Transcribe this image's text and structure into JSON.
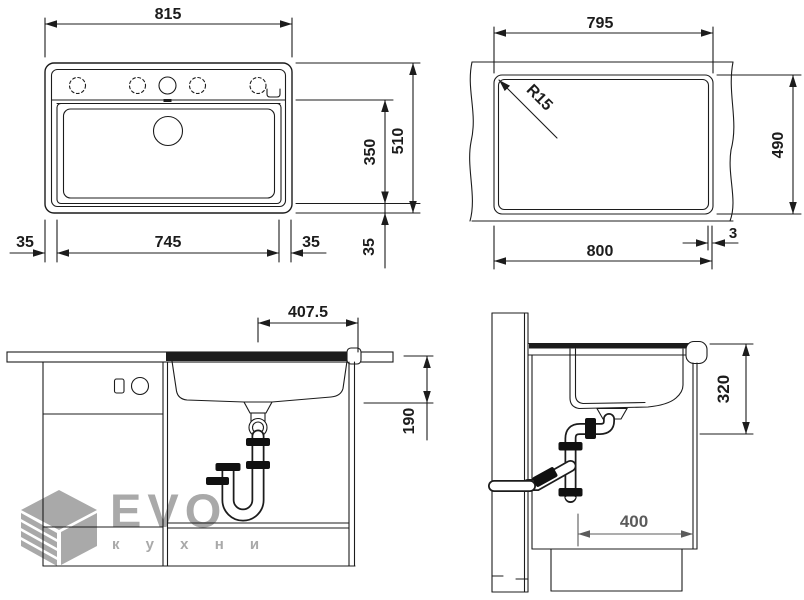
{
  "drawing": {
    "type": "sink-installation-technical-drawing",
    "colors": {
      "line": "#1c1c1c",
      "secondary_dim": "#5b5b5b",
      "logo": "#a9a9a9",
      "background": "#ffffff"
    },
    "views": {
      "top_view": {
        "dims": {
          "overall_width": "815",
          "bowl_width": "745",
          "left_margin": "35",
          "right_margin": "35",
          "overall_depth": "510",
          "bowl_depth": "350",
          "bottom_margin": "35"
        }
      },
      "cutout_view": {
        "dims": {
          "cutout_width_top": "795",
          "cutout_depth": "490",
          "cutout_width_bottom": "800",
          "edge_offset": "3",
          "corner_radius": "R15"
        }
      },
      "front_view": {
        "dims": {
          "drain_center_offset": "407.5",
          "drain_depth": "190"
        }
      },
      "side_view": {
        "dims": {
          "installation_depth": "320",
          "rear_clearance": "400"
        }
      }
    }
  },
  "logo": {
    "brand": "EVO",
    "tagline": "к у х н и"
  }
}
